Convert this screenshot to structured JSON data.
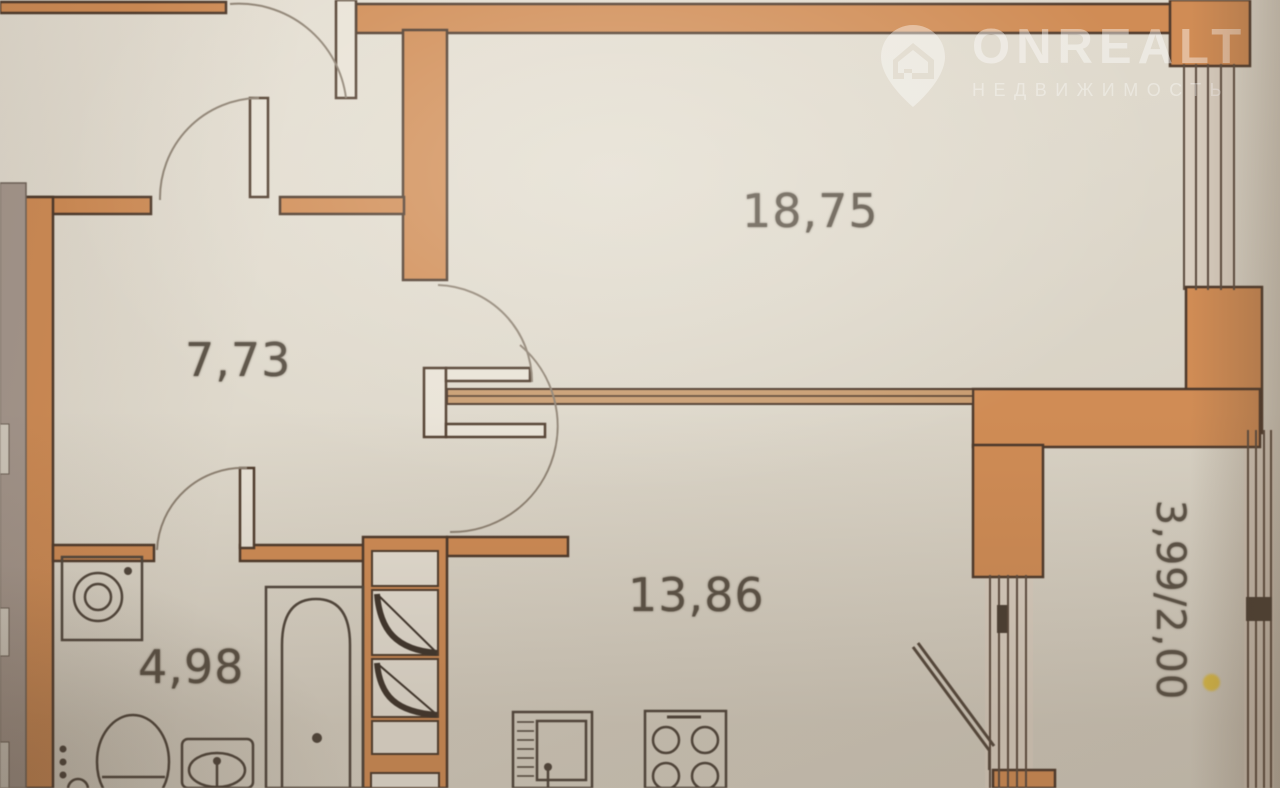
{
  "watermark": {
    "brand": "ONREALT",
    "tagline": "НЕДВИЖИМОСТЬ"
  },
  "floor_plan": {
    "room_labels": {
      "living_room": "18,75",
      "hallway": "7,73",
      "kitchen": "13,86",
      "bathroom": "4,98",
      "balcony": "3,99/2,00"
    },
    "colors": {
      "wall": "#d08c55",
      "wall_outline": "#4c382a",
      "paper": "#e2dcd0",
      "balcony_marker_dot": "#e3bd2d"
    }
  }
}
